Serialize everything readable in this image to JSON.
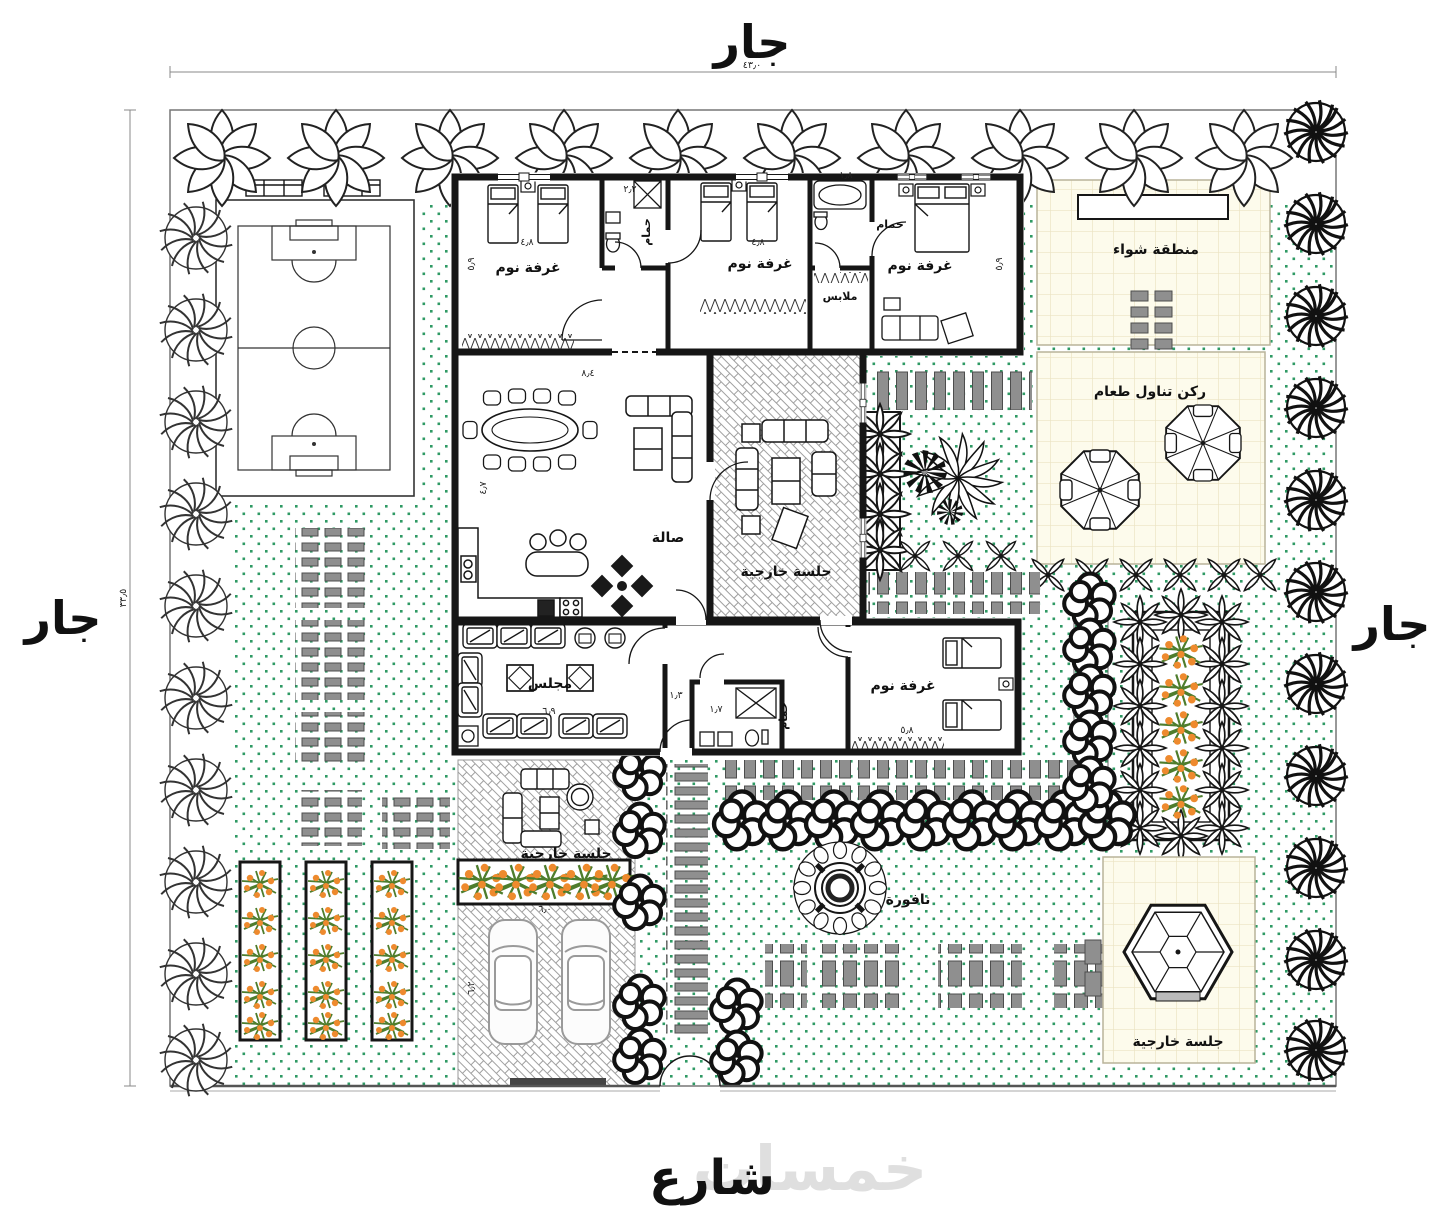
{
  "labels": {
    "neighbor": "جار",
    "street": "شارع",
    "watermark": "خمسات",
    "bedroom": "غرفة نوم",
    "bathroom": "حمام",
    "closet": "ملابس",
    "hall": "صالة",
    "majlis": "مجلس",
    "outdoor_seating": "جلسة خارجية",
    "bbq_area": "منطقة شواء",
    "dining_corner": "ركن تناول طعام",
    "fountain": "نافورة"
  },
  "dimensions": {
    "site_width": "٤٣٫٠",
    "site_height": "٣٣٫٥",
    "bedroom1_width": "٤٫٨",
    "bedroom2_width": "٤٫٨",
    "bedroom1_depth": "٥٫٩",
    "bedroom3_depth": "٥٫٩",
    "hall_width": "٨٫٤",
    "hall_depth": "٤٫٧",
    "bath1_width": "٢٫٢",
    "bath2_width": "١٫٨",
    "majlis_width": "٦٫٩",
    "corridor_width": "١٫٣",
    "wc_width": "١٫٧",
    "bedroom4_width": "٥٫٨",
    "garage_width": "٦٫٠",
    "garage_depth": "٦٫٢"
  },
  "colors": {
    "wall": "#161616",
    "grass_dot": "#2f9a64",
    "tile_bg": "#fdfbec",
    "tile_line": "#ebe3c2",
    "paver_gray": "#8f8f8f",
    "flower_orange": "#ee8a2e",
    "plant_green": "#4e7d2d",
    "watermark_gray": "#cfcfcf"
  }
}
